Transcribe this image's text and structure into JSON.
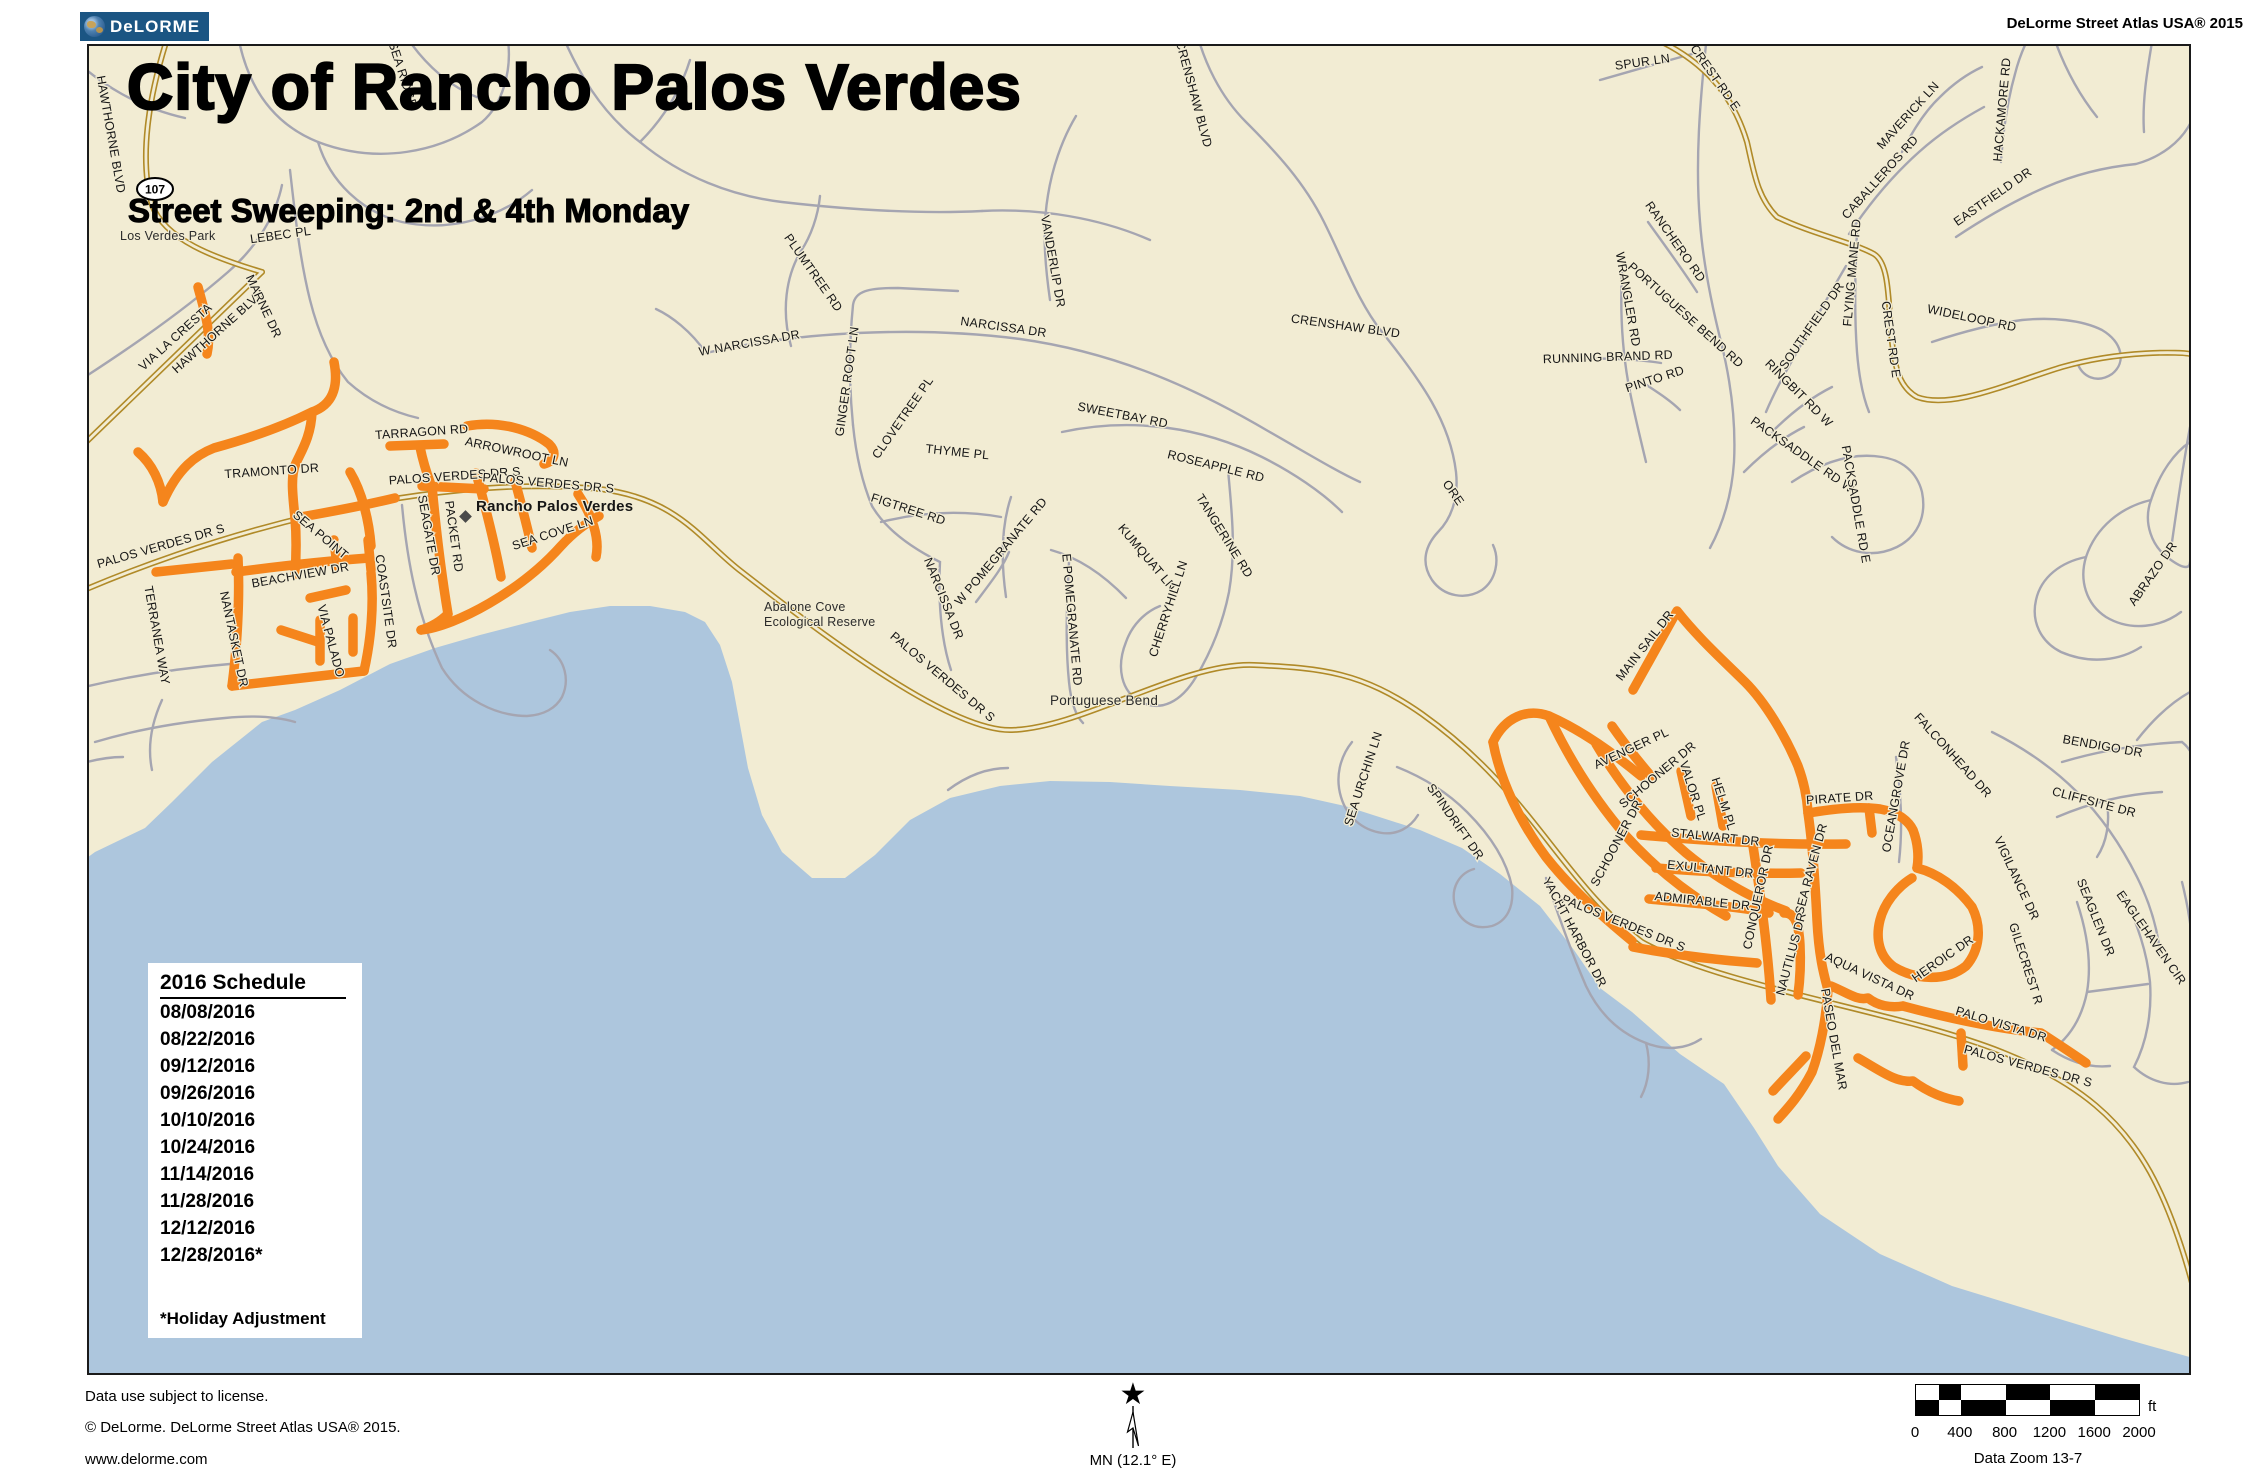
{
  "header": {
    "logo_text": "DeLORME",
    "atlas_title": "DeLorme Street Atlas USA® 2015"
  },
  "map": {
    "title": "City of Rancho Palos Verdes",
    "subtitle": "Street Sweeping: 2nd & 4th Monday",
    "route_shield": "107",
    "colors": {
      "land": "#F2ECD3",
      "water": "#ADC6DD",
      "minor_road": "#A5A5B1",
      "major_road_casing": "#B08A28",
      "major_road_fill": "#F2ECD3",
      "highlight_route": "#F5851C",
      "label": "#161616"
    },
    "labels": [
      {
        "t": "Los Verdes Park",
        "x": 120,
        "y": 240,
        "r": 0,
        "s": 12.5,
        "a": "start",
        "p": 1,
        "n": "label-los-verdes-park"
      },
      {
        "t": "Abalone Cove",
        "x": 764,
        "y": 611,
        "r": 0,
        "s": 12.5,
        "a": "start",
        "p": 1,
        "n": "label-abalone-cove"
      },
      {
        "t": "Ecological Reserve",
        "x": 764,
        "y": 626,
        "r": 0,
        "s": 12.5,
        "a": "start",
        "p": 1,
        "n": "label-abalone-cove2"
      },
      {
        "t": "Portuguese Bend",
        "x": 1050,
        "y": 705,
        "r": 0,
        "s": 13.5,
        "a": "start",
        "p": 1,
        "n": "label-portuguese-bend"
      },
      {
        "t": "Rancho Palos Verdes",
        "x": 476,
        "y": 511,
        "r": 0,
        "s": 15,
        "b": 1,
        "a": "start",
        "n": "label-city"
      },
      {
        "t": "SEA RIDGE",
        "x": 399,
        "y": 76,
        "r": 72
      },
      {
        "t": "CRENSHAW BLVD",
        "x": 1190,
        "y": 95,
        "r": 75
      },
      {
        "t": "CRENSHAW BLVD",
        "x": 1345,
        "y": 330,
        "r": 8
      },
      {
        "t": "HAWTHORNE BLVD",
        "x": 107,
        "y": 135,
        "r": 80
      },
      {
        "t": "VIA LA CRESTA",
        "x": 178,
        "y": 340,
        "r": -42
      },
      {
        "t": "HAWTHORNE BLVD",
        "x": 221,
        "y": 334,
        "r": -42
      },
      {
        "t": "MARNE DR",
        "x": 260,
        "y": 308,
        "r": 65
      },
      {
        "t": "LEBEC PL",
        "x": 281,
        "y": 239,
        "r": -8
      },
      {
        "t": "TERRANEA WAY",
        "x": 153,
        "y": 636,
        "r": 80
      },
      {
        "t": "PALOS VERDES DR S",
        "x": 162,
        "y": 550,
        "r": -16
      },
      {
        "t": "PALOS VERDES DR S",
        "x": 455,
        "y": 480,
        "r": -4
      },
      {
        "t": "PALOS VERDES DR S",
        "x": 548,
        "y": 487,
        "r": 5
      },
      {
        "t": "PALOS VERDES DR S",
        "x": 940,
        "y": 680,
        "r": 40
      },
      {
        "t": "PALOS VERDES DR S",
        "x": 1622,
        "y": 927,
        "r": 22
      },
      {
        "t": "PALOS VERDES DR S",
        "x": 2027,
        "y": 1070,
        "r": 15
      },
      {
        "t": "TRAMONTO DR",
        "x": 272,
        "y": 475,
        "r": -4
      },
      {
        "t": "TARRAGON RD",
        "x": 422,
        "y": 436,
        "r": -4
      },
      {
        "t": "ARROWROOT LN",
        "x": 516,
        "y": 456,
        "r": 12
      },
      {
        "t": "SEA POINT",
        "x": 318,
        "y": 538,
        "r": 40
      },
      {
        "t": "BEACHVIEW DR",
        "x": 301,
        "y": 579,
        "r": -10
      },
      {
        "t": "COASTSITE DR",
        "x": 382,
        "y": 602,
        "r": 82
      },
      {
        "t": "NANTASKET DR",
        "x": 230,
        "y": 640,
        "r": 78
      },
      {
        "t": "VIA PALADO",
        "x": 327,
        "y": 642,
        "r": 75
      },
      {
        "t": "SEAGATE DR",
        "x": 425,
        "y": 536,
        "r": 80
      },
      {
        "t": "PACKET RD",
        "x": 450,
        "y": 537,
        "r": 82
      },
      {
        "t": "SEA COVE LN",
        "x": 554,
        "y": 537,
        "r": -18
      },
      {
        "t": "W NARCISSA DR",
        "x": 750,
        "y": 347,
        "r": -10
      },
      {
        "t": "PLUMTREE RD",
        "x": 810,
        "y": 275,
        "r": 55
      },
      {
        "t": "GINGER ROOT LN",
        "x": 851,
        "y": 382,
        "r": -82
      },
      {
        "t": "NARCISSA DR",
        "x": 1003,
        "y": 331,
        "r": 8
      },
      {
        "t": "VANDERLIP DR",
        "x": 1049,
        "y": 262,
        "r": 80
      },
      {
        "t": "CLOVETREE PL",
        "x": 906,
        "y": 420,
        "r": -55
      },
      {
        "t": "THYME PL",
        "x": 957,
        "y": 456,
        "r": 6
      },
      {
        "t": "FIGTREE RD",
        "x": 907,
        "y": 513,
        "r": 18
      },
      {
        "t": "NARCISSA DR",
        "x": 940,
        "y": 600,
        "r": 68
      },
      {
        "t": "W POMEGRANATE RD",
        "x": 1004,
        "y": 554,
        "r": -50
      },
      {
        "t": "E POMEGRANATE RD",
        "x": 1068,
        "y": 620,
        "r": 85
      },
      {
        "t": "KUMQUAT LN",
        "x": 1144,
        "y": 560,
        "r": 50
      },
      {
        "t": "CHERRYHILL LN",
        "x": 1172,
        "y": 610,
        "r": -72
      },
      {
        "t": "SWEETBAY RD",
        "x": 1122,
        "y": 419,
        "r": 11
      },
      {
        "t": "ROSEAPPLE RD",
        "x": 1215,
        "y": 470,
        "r": 14
      },
      {
        "t": "TANGERINE RD",
        "x": 1221,
        "y": 538,
        "r": 58
      },
      {
        "t": "ORE",
        "x": 1450,
        "y": 495,
        "r": 55
      },
      {
        "t": "SEA URCHIN LN",
        "x": 1367,
        "y": 780,
        "r": -72
      },
      {
        "t": "SPINDRIFT DR",
        "x": 1452,
        "y": 824,
        "r": 55
      },
      {
        "t": "YACHT HARBOR DR",
        "x": 1571,
        "y": 934,
        "r": 62
      },
      {
        "t": "SPUR LN",
        "x": 1643,
        "y": 66,
        "r": -8
      },
      {
        "t": "CREST RD E",
        "x": 1712,
        "y": 80,
        "r": 55
      },
      {
        "t": "CREST RD E",
        "x": 1887,
        "y": 340,
        "r": 82
      },
      {
        "t": "MAVERICK LN",
        "x": 1911,
        "y": 118,
        "r": -48
      },
      {
        "t": "CABALLEROS RD",
        "x": 1883,
        "y": 180,
        "r": -48
      },
      {
        "t": "HACKAMORE RD",
        "x": 2006,
        "y": 110,
        "r": -85
      },
      {
        "t": "EASTFIELD DR",
        "x": 1995,
        "y": 200,
        "r": -35
      },
      {
        "t": "RANCHERO RD",
        "x": 1672,
        "y": 244,
        "r": 55
      },
      {
        "t": "WRANGLER RD",
        "x": 1624,
        "y": 300,
        "r": 80
      },
      {
        "t": "PORTUGUESE BEND RD",
        "x": 1683,
        "y": 318,
        "r": 42
      },
      {
        "t": "RUNNING BRAND RD",
        "x": 1608,
        "y": 361,
        "r": -2
      },
      {
        "t": "PINTO RD",
        "x": 1656,
        "y": 383,
        "r": -18
      },
      {
        "t": "SOUTHFIELD DR",
        "x": 1815,
        "y": 328,
        "r": -55
      },
      {
        "t": "FLYING MANE RD",
        "x": 1856,
        "y": 273,
        "r": -85
      },
      {
        "t": "RINGBIT RD W",
        "x": 1796,
        "y": 396,
        "r": 45
      },
      {
        "t": "WIDELOOP RD",
        "x": 1971,
        "y": 322,
        "r": 12
      },
      {
        "t": "PACKSADDLE RD W",
        "x": 1800,
        "y": 458,
        "r": 35
      },
      {
        "t": "PACKSADDLE RD E",
        "x": 1852,
        "y": 505,
        "r": 80
      },
      {
        "t": "ABRAZO DR",
        "x": 2156,
        "y": 576,
        "r": -55
      },
      {
        "t": "BENDIGO DR",
        "x": 2102,
        "y": 750,
        "r": 10
      },
      {
        "t": "CLIFFSITE DR",
        "x": 2093,
        "y": 806,
        "r": 15
      },
      {
        "t": "FALCONHEAD DR",
        "x": 1950,
        "y": 758,
        "r": 48
      },
      {
        "t": "OCEANGROVE DR",
        "x": 1900,
        "y": 797,
        "r": -80
      },
      {
        "t": "VIGILANCE DR",
        "x": 2013,
        "y": 880,
        "r": 65
      },
      {
        "t": "SEAGLEN DR",
        "x": 2092,
        "y": 919,
        "r": 68
      },
      {
        "t": "EAGLEHAVEN CIR",
        "x": 2148,
        "y": 940,
        "r": 55
      },
      {
        "t": "GILECREST R",
        "x": 2022,
        "y": 965,
        "r": 72
      },
      {
        "t": "HEROIC DR",
        "x": 1945,
        "y": 962,
        "r": -35
      },
      {
        "t": "PIRATE DR",
        "x": 1840,
        "y": 802,
        "r": -4
      },
      {
        "t": "SEA RAVEN DR",
        "x": 1815,
        "y": 870,
        "r": -75
      },
      {
        "t": "NAUTILUS DR",
        "x": 1795,
        "y": 955,
        "r": -75
      },
      {
        "t": "PASEO DEL MAR",
        "x": 1830,
        "y": 1040,
        "r": 80
      },
      {
        "t": "AQUA VISTA DR",
        "x": 1868,
        "y": 980,
        "r": 25
      },
      {
        "t": "PALO VISTA DR",
        "x": 2000,
        "y": 1028,
        "r": 17
      },
      {
        "t": "MAIN SAIL DR",
        "x": 1648,
        "y": 648,
        "r": -52
      },
      {
        "t": "AVENGER PL",
        "x": 1633,
        "y": 752,
        "r": -25
      },
      {
        "t": "SCHOONER DR",
        "x": 1660,
        "y": 778,
        "r": -40
      },
      {
        "t": "SCHOONER DR",
        "x": 1620,
        "y": 845,
        "r": -62
      },
      {
        "t": "VALOR PL",
        "x": 1689,
        "y": 792,
        "r": 72
      },
      {
        "t": "HELM PL",
        "x": 1720,
        "y": 805,
        "r": 72
      },
      {
        "t": "STALWART DR",
        "x": 1715,
        "y": 841,
        "r": 6
      },
      {
        "t": "EXULTANT DR",
        "x": 1710,
        "y": 873,
        "r": 6
      },
      {
        "t": "ADMIRABLE DR",
        "x": 1702,
        "y": 905,
        "r": 6
      },
      {
        "t": "CONQUEROR DR",
        "x": 1762,
        "y": 898,
        "r": -78
      }
    ]
  },
  "schedule": {
    "title": "2016 Schedule",
    "dates": [
      "08/08/2016",
      "08/22/2016",
      "09/12/2016",
      "09/26/2016",
      "10/10/2016",
      "10/24/2016",
      "11/14/2016",
      "11/28/2016",
      "12/12/2016",
      "12/28/2016*"
    ],
    "note": "*Holiday Adjustment"
  },
  "footer": {
    "license": "Data use subject to license.",
    "copyright": "© DeLorme. DeLorme Street Atlas USA® 2015.",
    "website": "www.delorme.com",
    "compass_label": "MN (12.1° E)",
    "scale": {
      "ticks": [
        "0",
        "400",
        "800",
        "1200",
        "1600",
        "2000"
      ],
      "unit": "ft",
      "data_zoom": "Data Zoom 13-7"
    }
  }
}
